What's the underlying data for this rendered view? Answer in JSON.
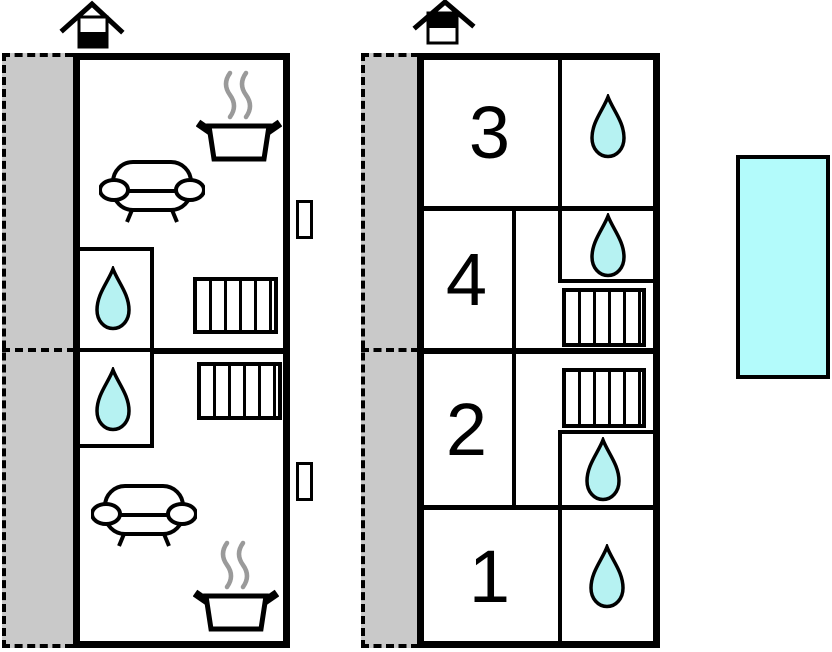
{
  "colors": {
    "water": "#b6f2f2",
    "pool": "#b3fbfb",
    "terrace": "#c9c9c9",
    "steam": "#9a9a9a",
    "wall": "#000000"
  },
  "right_unit": {
    "rooms": [
      {
        "label": "3"
      },
      {
        "label": "4"
      },
      {
        "label": "2"
      },
      {
        "label": "1"
      }
    ]
  },
  "icons": {
    "chimney": "chimney-icon",
    "water_drop": "water-drop-icon",
    "radiator": "radiator-icon",
    "sofa": "sofa-icon",
    "stove_pot": "stove-pot-icon",
    "window": "window-icon",
    "terrace": "terrace",
    "pool": "pool"
  }
}
